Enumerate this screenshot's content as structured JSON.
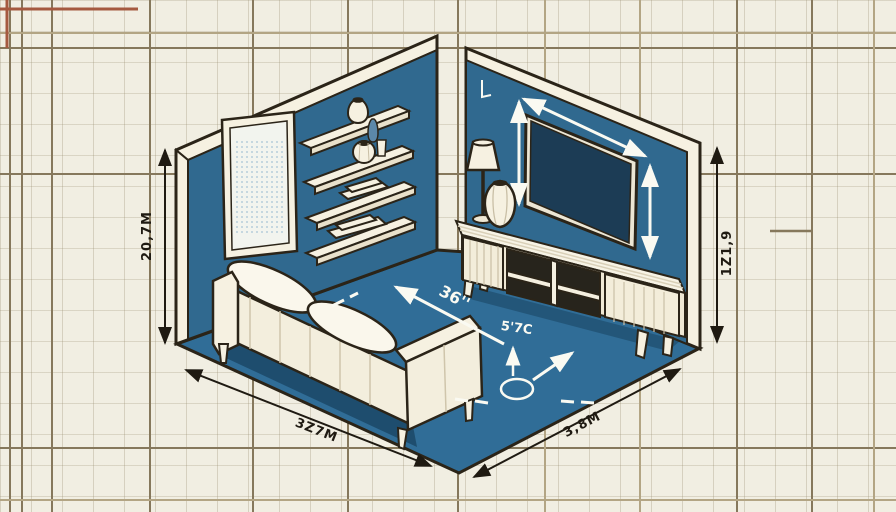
{
  "annotations": {
    "left_wall_height": "20,7M",
    "right_wall_height": "1Z1,9",
    "floor_left_width": "3Z7M",
    "floor_right_width": "3,8M",
    "floor_diagonal": "36''",
    "floor_center_mark": "5'7C"
  },
  "colors": {
    "background": "#f1eee2",
    "grid_thin": "#c9c1a6",
    "grid_accent": "#86785c",
    "grid_accent_light": "#b3a584",
    "grid_accent_red": "#a55a40",
    "wall_blue": "#30698f",
    "floor_blue": "#306d97",
    "shadow_blue": "#1b4866",
    "tv_screen": "#1c3c55",
    "furniture_cream": "#f6f1e1",
    "furniture_shade": "#e9e1cb",
    "outline": "#2b2418",
    "annotation_white": "#fafaf2",
    "accent_blue_glass": "#5c88a9"
  }
}
